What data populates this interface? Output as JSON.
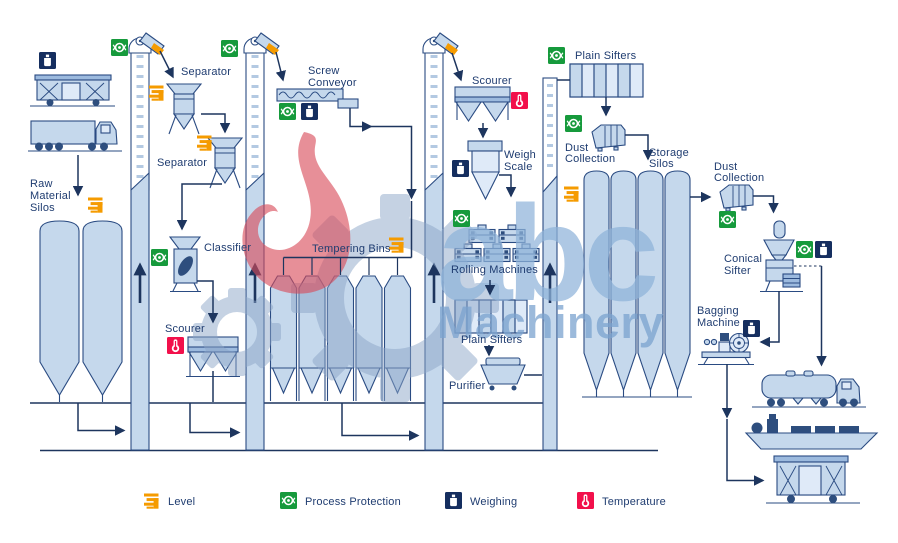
{
  "diagram_title": "grain milling process flow",
  "labels": {
    "raw_material_silos": [
      "Raw",
      "Material",
      "Silos"
    ],
    "separator_top": [
      "Separator"
    ],
    "separator_mid": [
      "Separator"
    ],
    "screw_conveyor": [
      "Screw",
      "Conveyor"
    ],
    "classifier": [
      "Classifier"
    ],
    "scourer_left": [
      "Scourer"
    ],
    "tempering_bins": [
      "Tempering Bins"
    ],
    "scourer_right": [
      "Scourer"
    ],
    "weigh_scale": [
      "Weigh",
      "Scale"
    ],
    "rolling_machines": [
      "Rolling Machines"
    ],
    "plain_sifters_mid": [
      "Plain Sifters"
    ],
    "purifier": [
      "Purifier"
    ],
    "plain_sifters_top": [
      "Plain Sifters"
    ],
    "dust_collection_top": [
      "Dust",
      "Collection"
    ],
    "storage_silos": [
      "Storage",
      "Silos"
    ],
    "dust_collection_right": [
      "Dust",
      "Collection"
    ],
    "conical_sifter": [
      "Conical",
      "Sifter"
    ],
    "bagging_machine": [
      "Bagging",
      "Machine"
    ]
  },
  "legend": {
    "items": [
      {
        "icon": "level-icon",
        "label": "Level",
        "color": "#F59B00"
      },
      {
        "icon": "process-protection-icon",
        "label": "Process Protection",
        "color": "#169A3C"
      },
      {
        "icon": "weighing-icon",
        "label": "Weighing",
        "color": "#152E5F"
      },
      {
        "icon": "temperature-icon",
        "label": "Temperature",
        "color": "#F2104B"
      }
    ]
  },
  "watermark": {
    "logo_text": "abc",
    "logo_subtext": "Machinery",
    "flame_color": "#E78F98",
    "text_color": "#AEC9E4"
  },
  "colors": {
    "equipment_fill": "#C5D8EC",
    "outline_navy": "#2A4B82",
    "flow_navy": "#1D355E",
    "accent_orange": "#F59B00",
    "accent_green": "#169A3C",
    "accent_navy": "#152E5F",
    "accent_red": "#F2104B"
  }
}
